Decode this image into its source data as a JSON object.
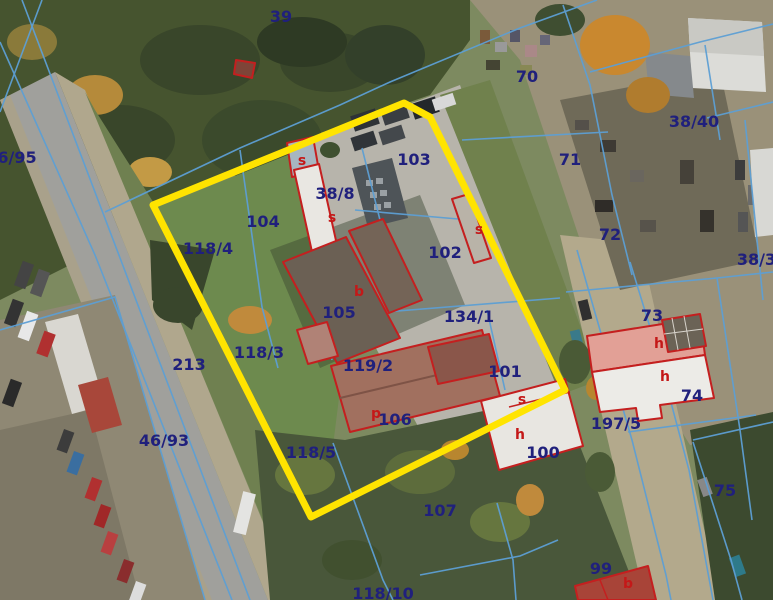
{
  "map": {
    "type": "cadastral-aerial-map",
    "colors": {
      "parcel_label": "#20207c",
      "building_label": "#c41818",
      "cadastral_line": "#5d9fd4",
      "building_outline": "#c41f1f",
      "highlight": "#ffe400"
    },
    "highlight_polygon": "153,205 404,103 430,117 565,390 311,517",
    "parcel_labels": [
      {
        "text": "39",
        "x": 281,
        "y": 17
      },
      {
        "text": "6/95",
        "x": 17,
        "y": 158
      },
      {
        "text": "70",
        "x": 527,
        "y": 77
      },
      {
        "text": "38/40",
        "x": 694,
        "y": 122
      },
      {
        "text": "71",
        "x": 570,
        "y": 160
      },
      {
        "text": "103",
        "x": 414,
        "y": 160
      },
      {
        "text": "104",
        "x": 263,
        "y": 222
      },
      {
        "text": "118/4",
        "x": 208,
        "y": 249
      },
      {
        "text": "38/8",
        "x": 335,
        "y": 194
      },
      {
        "text": "102",
        "x": 445,
        "y": 253
      },
      {
        "text": "72",
        "x": 610,
        "y": 235
      },
      {
        "text": "38/38",
        "x": 762,
        "y": 260
      },
      {
        "text": "134/1",
        "x": 469,
        "y": 317
      },
      {
        "text": "73",
        "x": 652,
        "y": 316
      },
      {
        "text": "74",
        "x": 692,
        "y": 396
      },
      {
        "text": "197/5",
        "x": 616,
        "y": 424
      },
      {
        "text": "101",
        "x": 505,
        "y": 372
      },
      {
        "text": "105",
        "x": 339,
        "y": 313
      },
      {
        "text": "118/3",
        "x": 259,
        "y": 353
      },
      {
        "text": "119/2",
        "x": 368,
        "y": 366
      },
      {
        "text": "106",
        "x": 395,
        "y": 420
      },
      {
        "text": "100",
        "x": 543,
        "y": 453
      },
      {
        "text": "213",
        "x": 189,
        "y": 365
      },
      {
        "text": "46/93",
        "x": 164,
        "y": 441
      },
      {
        "text": "118/5",
        "x": 311,
        "y": 453
      },
      {
        "text": "107",
        "x": 440,
        "y": 511
      },
      {
        "text": "118/10",
        "x": 383,
        "y": 594
      },
      {
        "text": "99",
        "x": 601,
        "y": 569
      },
      {
        "text": "75",
        "x": 725,
        "y": 491
      }
    ],
    "building_labels": [
      {
        "text": "s",
        "x": 302,
        "y": 161
      },
      {
        "text": "s",
        "x": 332,
        "y": 218
      },
      {
        "text": "s",
        "x": 479,
        "y": 230
      },
      {
        "text": "b",
        "x": 359,
        "y": 292
      },
      {
        "text": "p",
        "x": 376,
        "y": 414
      },
      {
        "text": "s",
        "x": 522,
        "y": 400
      },
      {
        "text": "h",
        "x": 520,
        "y": 435
      },
      {
        "text": "h",
        "x": 659,
        "y": 344
      },
      {
        "text": "h",
        "x": 665,
        "y": 377
      },
      {
        "text": "b",
        "x": 628,
        "y": 584
      }
    ]
  }
}
